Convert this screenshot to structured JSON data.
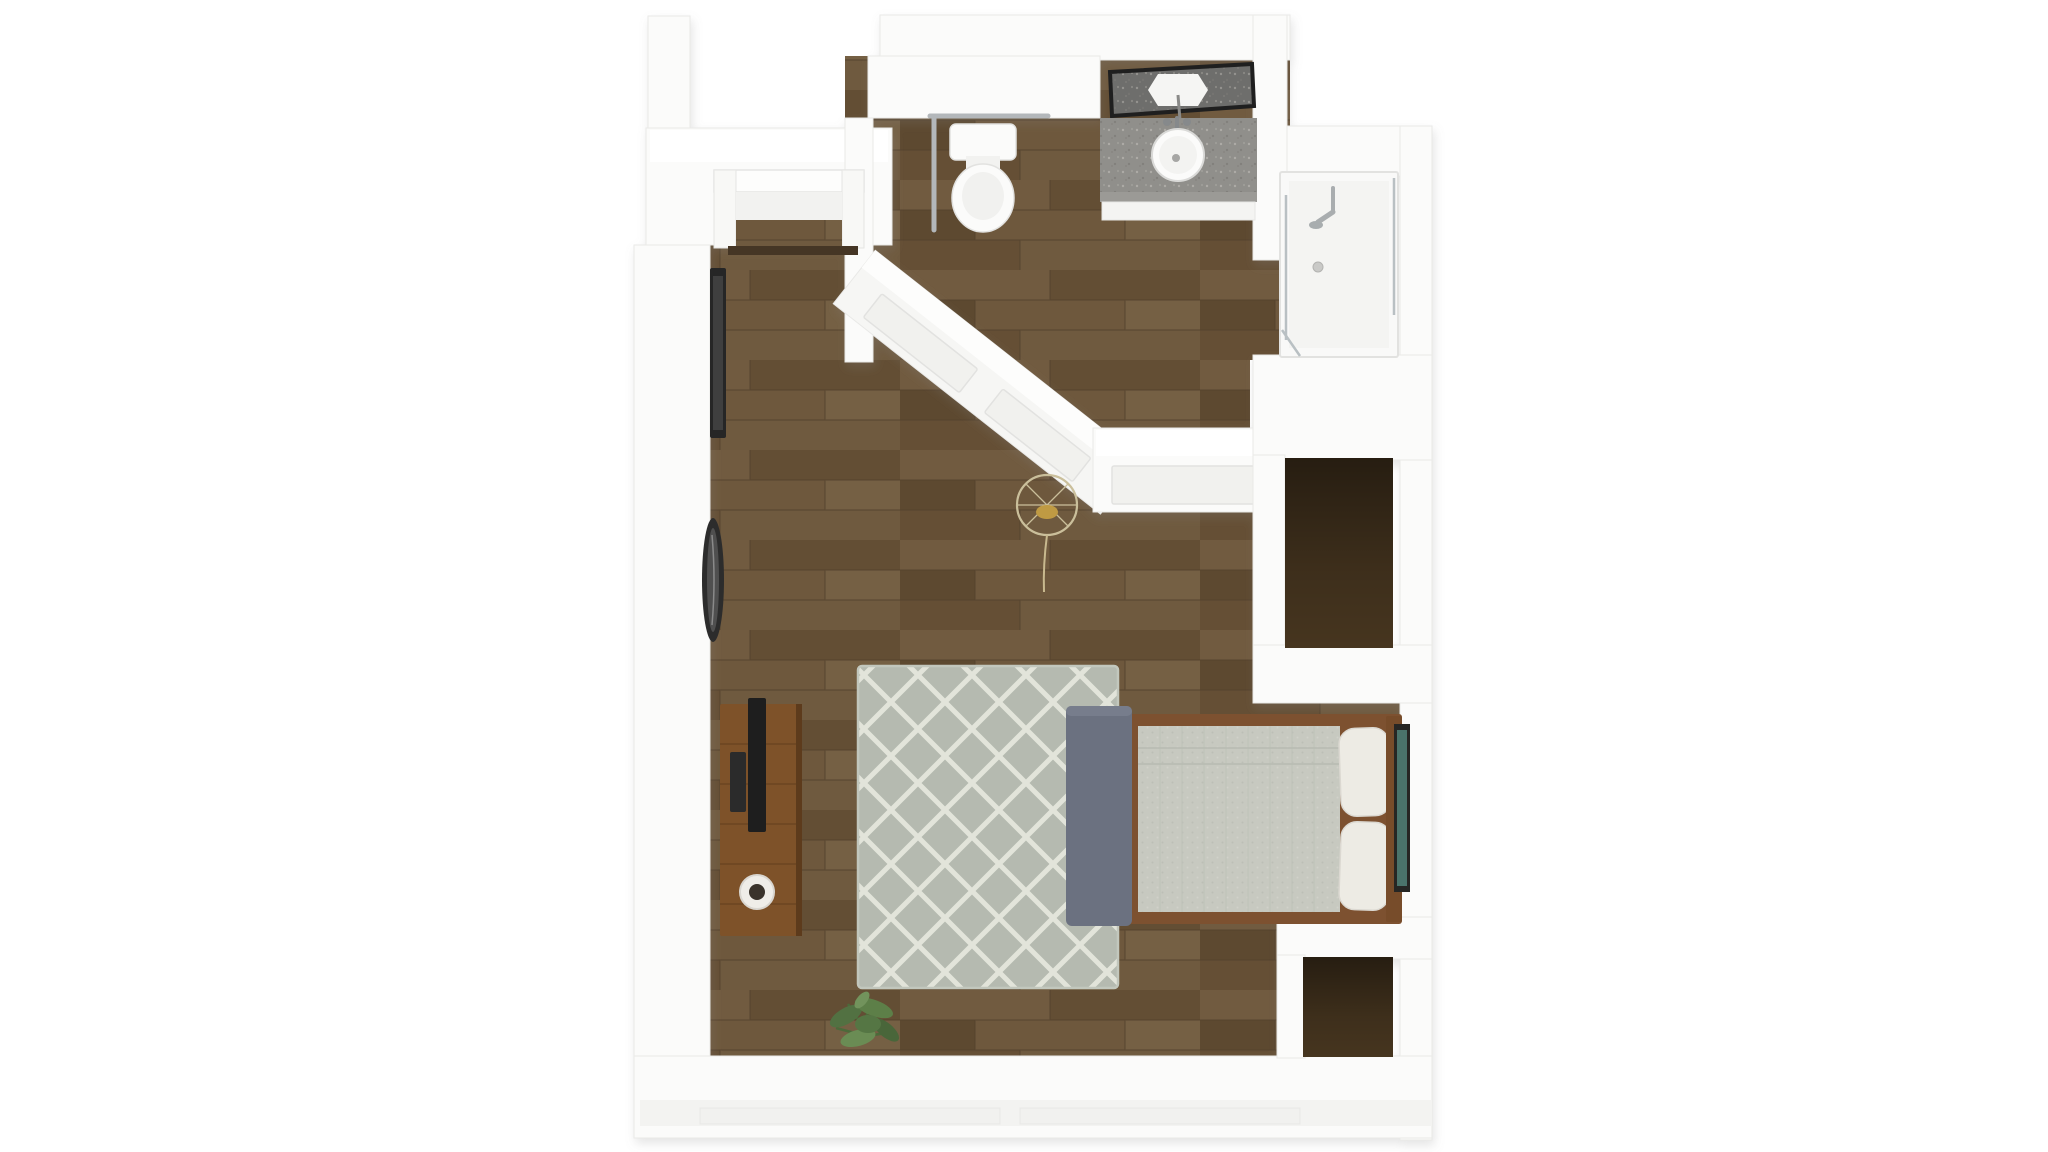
{
  "scene": {
    "type": "3d-floor-plan-render",
    "background": "#ffffff",
    "colors": {
      "wall": "#fbfbfa",
      "wall_top": "#ffffff",
      "wall_face": "#f3f3f1",
      "wood_floor": "#6b553c",
      "wood_floor_line": "#52402b",
      "closet_floor": "#46351f",
      "rug": "#b5bab0",
      "rug_pattern": "#e4e6dc",
      "bedding": "#c7c9c0",
      "pillow": "#edebe4",
      "bed_frame": "#7d5130",
      "headboard": "#774c2a",
      "bench": "#6b7180",
      "art_frame": "#262624",
      "art_canvas": "#4a736b",
      "console": "#7e5229",
      "tv": "#1e1e1e",
      "mug": "#efede8",
      "mug_contents": "#3a332b",
      "plant": "#5d7f48",
      "pendant_gold": "#bf9a43",
      "pendant_wire": "#cabf9b",
      "counter": "#908f8b",
      "mirror_frame": "#1f1f1f",
      "mirror_glass": "#6e6e6c",
      "fixture_metal": "#a8adaf",
      "grab_bar": "#b3b7ba",
      "threshold": "#453625",
      "shower_glass": "#b9c0c3",
      "porcelain": "#fbfbfa",
      "frame_dark": "#262626"
    },
    "rooms": {
      "entry": {
        "items": [
          "entry-door",
          "threshold",
          "hallway"
        ]
      },
      "bathroom": {
        "items": [
          "toilet",
          "grab-bar",
          "vanity-counter",
          "vessel-sink",
          "faucet",
          "mirror",
          "walk-in-shower",
          "shower-fixture",
          "shower-drain",
          "glass-panels"
        ]
      },
      "living_area": {
        "items": [
          "area-rug",
          "bed",
          "mattress-bedding",
          "pillows",
          "headboard",
          "foot-bench",
          "wall-art",
          "media-console",
          "tv",
          "mug",
          "floor-plant",
          "pendant-light",
          "picture-frame",
          "oval-wall-mirror",
          "wainscot-half-wall"
        ]
      },
      "closets": {
        "items": [
          "upper-closet",
          "lower-closet"
        ]
      }
    }
  }
}
